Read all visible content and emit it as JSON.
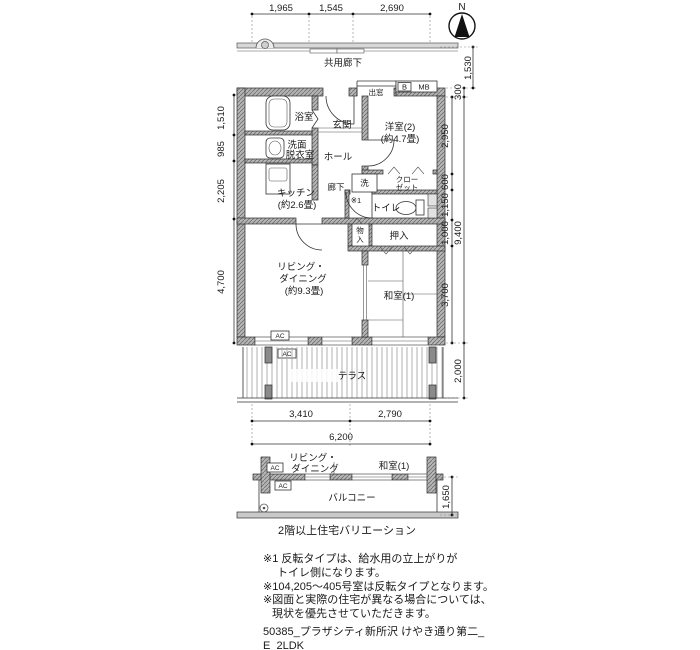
{
  "compass": {
    "north_label": "N"
  },
  "plan": {
    "corridor_label": "共用廊下",
    "rooms": {
      "bath": "浴室",
      "entrance": "玄関",
      "hall": "ホール",
      "western2_line1": "洋室(2)",
      "western2_line2": "(約4.7畳)",
      "washroom_line1": "洗面",
      "washroom_line2": "脱衣室",
      "kitchen_line1": "キッチン",
      "kitchen_line2": "(約2.6畳)",
      "hallway": "廊下",
      "toilet": "トイレ",
      "living_line1": "リビング・",
      "living_line2": "ダイニング",
      "living_line3": "(約9.3畳)",
      "japanese": "和室(1)",
      "terrace": "テラス"
    },
    "fixtures": {
      "washer": "洗",
      "closet_line1": "クロー",
      "closet_line2": "ゼット",
      "storage_line1": "物",
      "storage_line2": "入",
      "oshiire": "押入",
      "bay_window": "出窓",
      "meter_b": "B",
      "meter_mb": "MB",
      "ac": "AC",
      "note_marker": "※1"
    }
  },
  "dimensions": {
    "top": [
      "1,965",
      "1,545",
      "2,690"
    ],
    "left": [
      "1,510",
      "985",
      "2,205",
      "4,700"
    ],
    "right_inner": [
      "2,950",
      "600",
      "1,150",
      "1,000",
      "3,700"
    ],
    "right_outer": {
      "seg_1530": "1,530",
      "seg_300": "300",
      "total": "9,400",
      "terrace": "2,000"
    },
    "bottom_upper": [
      "3,410",
      "2,790"
    ],
    "bottom_total": "6,200",
    "balcony": "1,650"
  },
  "variation": {
    "living_line1": "リビング・",
    "living_line2": "ダイニング",
    "japanese": "和室(1)",
    "balcony": "バルコニー",
    "ac": "AC",
    "caption": "2階以上住宅バリエーション"
  },
  "notes": {
    "line1": "※1 反転タイプは、給水用の立上がりが",
    "line2": "トイレ側になります。",
    "line3": "※104,205〜405号室は反転タイプとなります。",
    "line4": "※図面と実際の住宅が異なる場合については、",
    "line5": "現状を優先させていただきます。"
  },
  "footer": {
    "line1": "50385_プラザシティ新所沢 けやき通り第二_",
    "line2": "E_2LDK"
  },
  "colors": {
    "wall_fill": "#b5b5b5",
    "line": "#2b2b2b",
    "background": "#ffffff"
  }
}
